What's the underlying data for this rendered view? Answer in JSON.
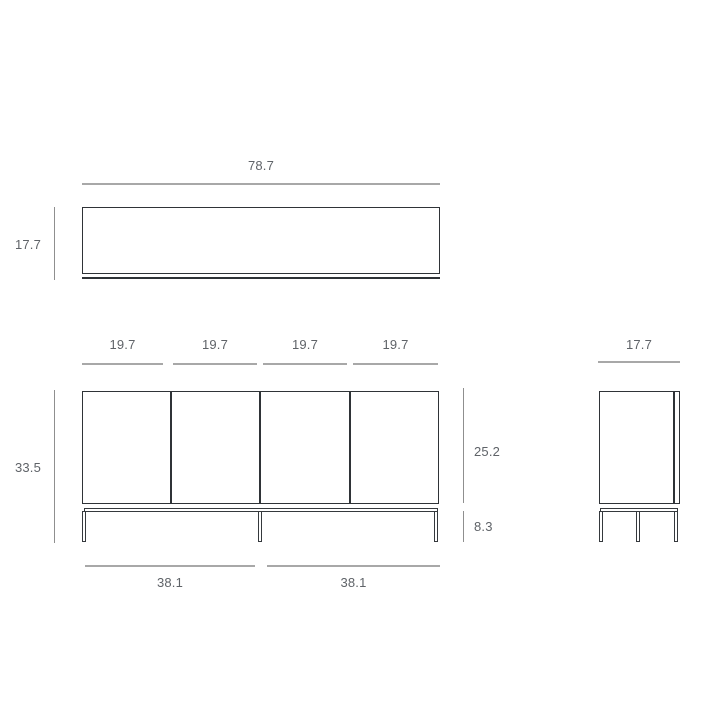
{
  "colors": {
    "background": "#ffffff",
    "object_line": "#2f3337",
    "dimension_line": "#a8a8a8",
    "label_text": "#5f6368"
  },
  "top_view": {
    "width_label": "78.7",
    "depth_label": "17.7"
  },
  "front_view": {
    "door_width_labels": [
      "19.7",
      "19.7",
      "19.7",
      "19.7"
    ],
    "overall_height_label": "33.5",
    "cabinet_height_label": "25.2",
    "leg_height_label": "8.3",
    "leg_span_labels": [
      "38.1",
      "38.1"
    ]
  },
  "side_view": {
    "depth_label": "17.7"
  }
}
